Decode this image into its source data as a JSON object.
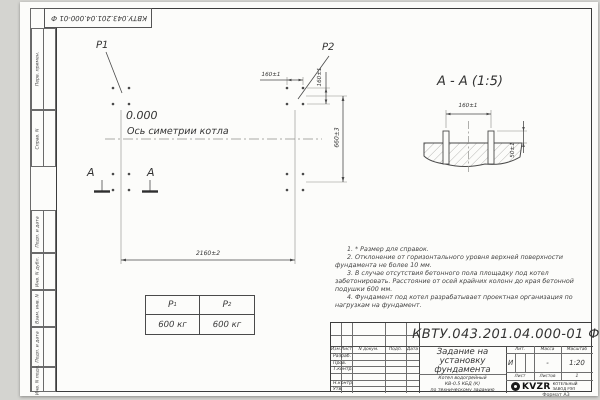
{
  "designation": "КВТУ.043.201.04.000-01  Ф",
  "frame_labels": [
    "Перв. примен.",
    "Справ. N",
    "Подп. и дата",
    "Инв. N дубл.",
    "Взам. инв. N",
    "Подп. и дата",
    "Инв. N подл."
  ],
  "plan": {
    "p1_label": "P1",
    "p2_label": "P2",
    "elevation": "0.000",
    "axis_label": "Ось симетрии котла",
    "dim_width": "2160±2",
    "dim_height": "660±3",
    "dim_bolt_horizontal": "160±1",
    "dim_bolt_vertical": "160±1",
    "section_letter_left": "А",
    "section_letter_right": "А"
  },
  "section": {
    "title": "А - А (1:5)",
    "dim_bolt_spacing": "160±1",
    "dim_protrusion": "50±1"
  },
  "load_table": {
    "col1": {
      "symbol": "P",
      "sub": "1",
      "value": "600 кг"
    },
    "col2": {
      "symbol": "P",
      "sub": "2",
      "value": "600 кг"
    }
  },
  "notes": [
    "1. * Размер для справок.",
    "2. Отклонение от горизонтального уровня верхней поверхности фундамента не более 10 мм.",
    "3. В случае отсутствия бетонного пола площадку под котел забетонировать. Расстояние от осей крайних колонн до края бетонной подушки 600 мм.",
    "4. Фундамент под котел разрабатывает проектная организация по нагрузкам на фундамент."
  ],
  "title_block": {
    "header_cols": [
      "Изм.",
      "Лист",
      "N докум.",
      "Подп.",
      "Дата"
    ],
    "sig_rows": [
      "Разраб.",
      "Пров.",
      "Т.контр.",
      "Н.контр.",
      "Утв."
    ],
    "doc_title_lines": [
      "Задание на",
      "установку",
      "фундамента"
    ],
    "product_lines": [
      "Котел водогрейный",
      "КВ-0.5 КБД (К)",
      "по техническому заданию"
    ],
    "lit_label": "Лит.",
    "lit_value": "И",
    "mass_label": "Масса",
    "mass_value": "-",
    "scale_label": "Масштаб",
    "scale_value": "1:20",
    "sheet_label": "Лист",
    "sheets_label": "Листов",
    "sheets_value": "1",
    "logo_text": "KVZR",
    "logo_sub_line1": "КОТЕЛЬНЫЙ",
    "logo_sub_line2": "ЗАВОД РЭП",
    "format_label": "Формат А3"
  }
}
